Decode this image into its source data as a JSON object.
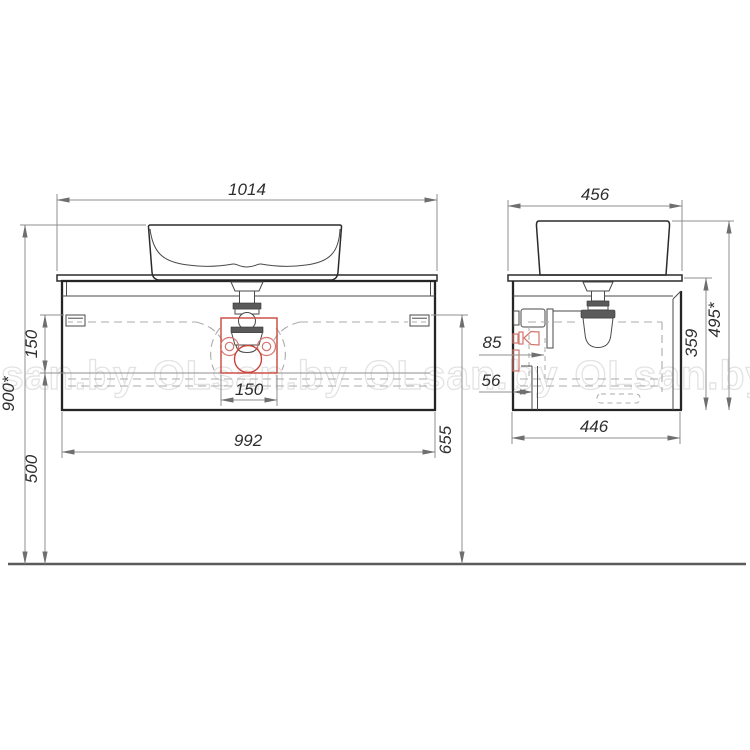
{
  "watermark": {
    "text": "OLsan.by",
    "repeat_count": 5,
    "stroke_color": "#e3e3e3"
  },
  "drawing": {
    "type": "furniture-technical-drawing",
    "subject": "wall-hung bathroom vanity cabinet with countertop washbasin and drain siphon",
    "views": [
      "front-view",
      "side-view"
    ],
    "front_view": {
      "dimensions": {
        "countertop_width": "1014",
        "overall_height": "900*",
        "slide_height": "150",
        "floor_clearance": "500",
        "cabinet_width": "992",
        "slide_to_floor": "655",
        "drain_cutout_width": "150"
      }
    },
    "side_view": {
      "dimensions": {
        "countertop_depth": "456",
        "overall_height": "495*",
        "cabinet_height": "359",
        "cabinet_depth": "446",
        "drain_wall_offset": "85",
        "pipe_wall_offset": "56"
      }
    },
    "colors": {
      "highlight_red": "#c9463d",
      "outline": "#252525",
      "dimension_gray": "#8f8f8f",
      "hidden_line_gray": "#ababab"
    }
  }
}
